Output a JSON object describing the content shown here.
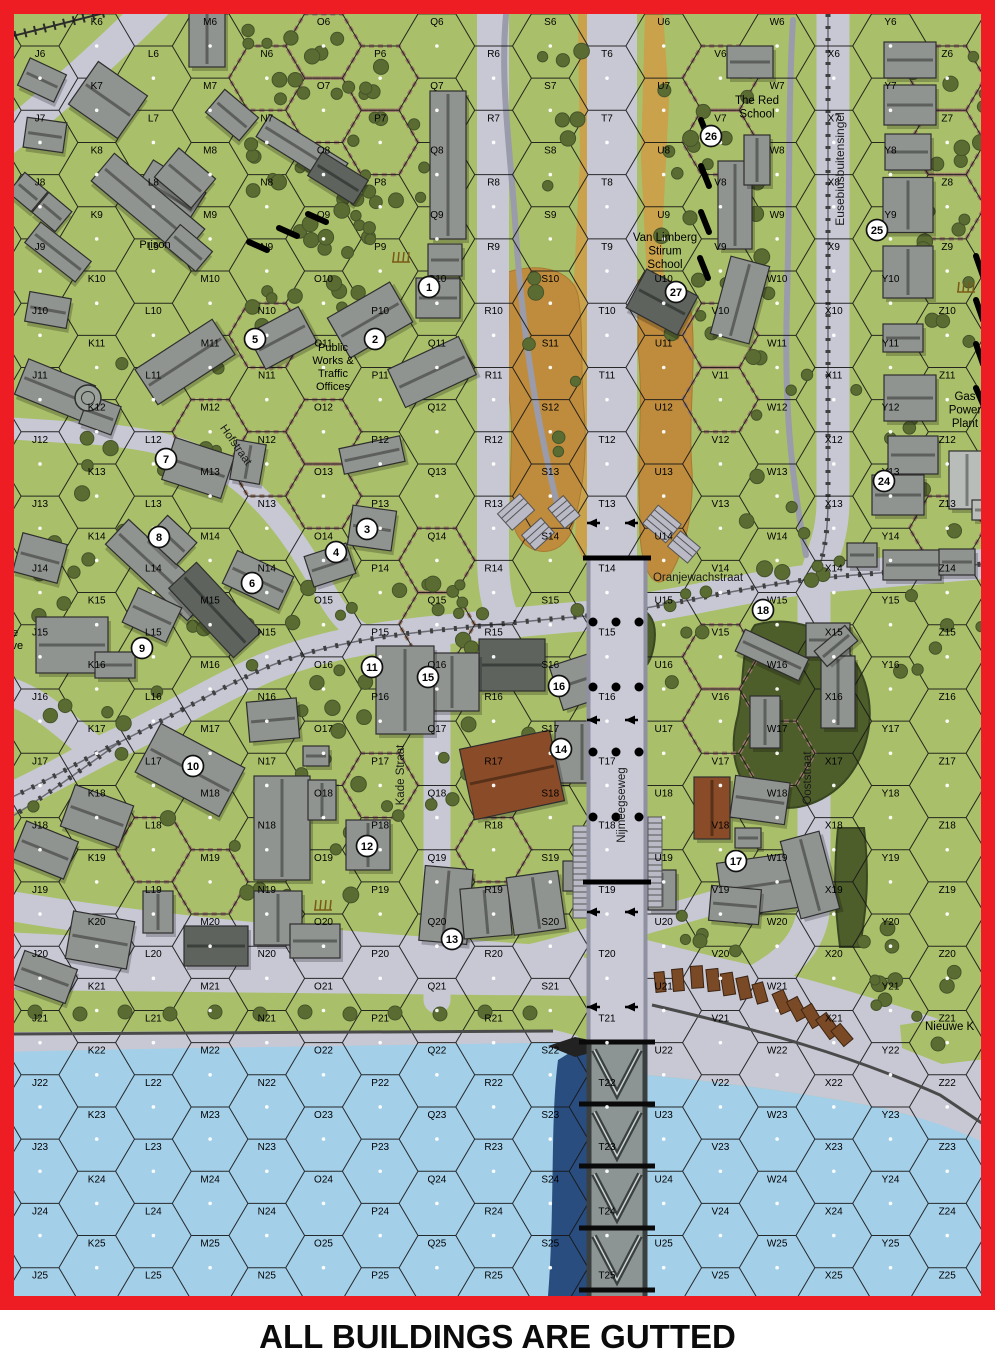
{
  "caption": {
    "text": "ALL BUILDINGS ARE GUTTED"
  },
  "colors": {
    "border": "#ee1c23",
    "green": "#a9bf69",
    "road": "#c7c8d4",
    "road_edge": "#9a9bab",
    "water": "#a4cfe9",
    "bridge_shadow": "#2a4d80",
    "dike_tan": "#c9a24b",
    "marsh": "#bf8c3e",
    "tree": "#5b6c33",
    "tree_edge": "#46542a",
    "woods": "#4e5e2b",
    "woods_edge": "#3a4722",
    "hedge": "#9b7a69",
    "grid": "#161616",
    "label": "#000000",
    "tram": "#3f3f3f",
    "quay_line": "#4a4a4a",
    "truss_deck": "#8d9494",
    "truss_dark": "#39403f",
    "truss_light": "#ccd3d2",
    "bldg_g": "#909490",
    "bldg_d": "#5e635e",
    "bldg_l": "#b9bdb9",
    "bldg_b": "#8a4c28",
    "bldg_stroke": "#2e2e2e",
    "marker_fill": "#ffffff",
    "marker_stroke": "#111111"
  },
  "grid": {
    "cols": "JKLMNOPQRSTUVWXYZ",
    "row_start": 6,
    "row_end": 25,
    "origin_x": 40,
    "col_pitch": 56.7,
    "row_pitch": 64.3,
    "hex_side": 37.8,
    "high_y": 46,
    "low_y": 78.15,
    "clip": [
      14,
      14,
      967,
      1282
    ]
  },
  "streets": [
    {
      "text": "Hofstraat",
      "x": 233,
      "y": 447,
      "rot": 55,
      "size": 11.5
    },
    {
      "text": "Kade Straat",
      "x": 404,
      "y": 775,
      "rot": -90,
      "size": 11.5
    },
    {
      "text": "Nijmeegseweg",
      "x": 625,
      "y": 805,
      "rot": -90,
      "size": 11.5
    },
    {
      "text": "Ooststraat",
      "x": 811,
      "y": 778,
      "rot": -90,
      "size": 11.5
    },
    {
      "text": "Eusebiusbuitensingel",
      "x": 844,
      "y": 169,
      "rot": -90,
      "size": 12
    },
    {
      "text": "Oranjewachstraat",
      "x": 698,
      "y": 581,
      "rot": 0,
      "size": 11.5
    }
  ],
  "landmarks": [
    {
      "lines": [
        "Prison"
      ],
      "x": 155,
      "y": 248,
      "size": 11,
      "anchor": "middle"
    },
    {
      "lines": [
        "The Red",
        "School"
      ],
      "x": 757,
      "y": 104,
      "size": 11.5,
      "anchor": "middle"
    },
    {
      "lines": [
        "Van Limberg",
        "Stirum",
        "School"
      ],
      "x": 665,
      "y": 241,
      "size": 11.5,
      "anchor": "middle"
    },
    {
      "lines": [
        "Public",
        "Works &",
        "Traffic",
        "Offices"
      ],
      "x": 333,
      "y": 351,
      "size": 11,
      "anchor": "middle"
    },
    {
      "lines": [
        "Gas",
        "Power",
        "Plant"
      ],
      "x": 965,
      "y": 400,
      "size": 11.5,
      "anchor": "middle"
    },
    {
      "lines": [
        "Nieuwe K"
      ],
      "x": 925,
      "y": 1030,
      "size": 11.5,
      "anchor": "start"
    },
    {
      "lines": [
        "ate",
        "hive"
      ],
      "x": 3,
      "y": 636,
      "size": 11,
      "anchor": "start"
    }
  ],
  "markers": [
    {
      "n": "1",
      "x": 429,
      "y": 287
    },
    {
      "n": "2",
      "x": 375,
      "y": 339
    },
    {
      "n": "3",
      "x": 367,
      "y": 529
    },
    {
      "n": "4",
      "x": 336,
      "y": 552
    },
    {
      "n": "5",
      "x": 255,
      "y": 339
    },
    {
      "n": "6",
      "x": 252,
      "y": 583
    },
    {
      "n": "7",
      "x": 166,
      "y": 459
    },
    {
      "n": "8",
      "x": 159,
      "y": 537
    },
    {
      "n": "9",
      "x": 142,
      "y": 648
    },
    {
      "n": "10",
      "x": 193,
      "y": 766
    },
    {
      "n": "11",
      "x": 372,
      "y": 667
    },
    {
      "n": "12",
      "x": 367,
      "y": 846
    },
    {
      "n": "13",
      "x": 452,
      "y": 939
    },
    {
      "n": "14",
      "x": 561,
      "y": 749
    },
    {
      "n": "15",
      "x": 428,
      "y": 677
    },
    {
      "n": "16",
      "x": 559,
      "y": 686
    },
    {
      "n": "17",
      "x": 736,
      "y": 861
    },
    {
      "n": "18",
      "x": 763,
      "y": 610
    },
    {
      "n": "24",
      "x": 884,
      "y": 481
    },
    {
      "n": "25",
      "x": 877,
      "y": 230
    },
    {
      "n": "26",
      "x": 711,
      "y": 136
    },
    {
      "n": "27",
      "x": 676,
      "y": 292
    }
  ],
  "roads": [
    {
      "d": "M493,10 L493,555 Q493,605 508,626",
      "w": 32
    },
    {
      "d": "M612,10 L612,565",
      "w": 50
    },
    {
      "d": "M833,10 L833,500 C833,540 820,558 814,585 L814,900 C814,940 790,965 745,987 L660,1008",
      "w": 33
    },
    {
      "d": "M10,798 C60,775 90,755 120,742 C180,712 220,688 265,668 C320,645 380,636 440,630 L520,622 C560,618 585,616 612,614 L690,600 C740,590 780,582 832,577 L995,563",
      "w": 30
    },
    {
      "d": "M75,432 C130,436 180,442 225,470 C270,500 300,545 330,600 C345,625 362,638 385,643",
      "w": 22
    },
    {
      "d": "M155,5 C110,50 60,95 5,140",
      "w": 32
    },
    {
      "d": "M5,428 L80,433",
      "w": 22
    },
    {
      "d": "M5,690 C40,700 70,730 98,753",
      "w": 28
    },
    {
      "d": "M437,636 L437,1000",
      "w": 27
    },
    {
      "d": "M5,905 C120,925 250,938 400,950 L570,962",
      "w": 30
    },
    {
      "d": "M510,960 C560,952 615,930 660,918 C700,907 722,900 742,895",
      "w": 24
    },
    {
      "d": "M506,15 C500,80 510,150 515,220 C520,300 530,380 545,450 C551,480 556,500 560,515",
      "w": 6,
      "c": "road_edge"
    },
    {
      "d": "M793,20 C788,100 790,200 787,300 C784,400 790,470 806,555",
      "w": 6,
      "c": "road_edge"
    }
  ],
  "tram_lines": [
    "M10,798 C60,775 90,755 120,742 C180,712 220,688 265,668 C320,645 380,636 440,630 L520,622 C560,618 585,616 612,614 L690,600 C740,590 780,582 832,577 L995,563",
    "M120,742 C95,760 70,778 45,795 C30,805 20,812 6,820",
    "M828,14 L828,500 C828,540 822,558 817,577"
  ],
  "rail": {
    "d": "M5,38 L108,12"
  },
  "dikes": [
    {
      "d": "M578,14 L592,14 L589,120 L594,260 L589,400 L592,520 L584,562 L575,540 L580,420 L573,300 L580,160 Z"
    },
    {
      "d": "M645,14 L663,14 L669,100 L662,240 L669,380 L660,520 L650,566 L642,440 L648,300 L641,160 Z"
    }
  ],
  "marshes": [
    {
      "d": "M508,272 C540,262 572,270 578,295 C584,330 580,370 584,410 C588,455 582,500 570,535 C555,560 525,555 515,530 C505,490 515,450 510,405 C505,360 512,315 508,272 Z"
    },
    {
      "d": "M638,280 C668,272 690,285 692,320 C696,370 688,420 692,470 C694,510 686,548 670,575 C652,598 638,560 640,520 C636,460 644,400 638,350 Z"
    }
  ],
  "shore": {
    "west_street_band": "M5,932 L200,942 L420,952 L587,958 L587,996 L5,990 Z",
    "west_green_strip": "M5,998 L550,996 L557,1030 L5,1032 Z",
    "west_quay_band": "M5,1032 L555,1030 L578,1036 L578,1054 L5,1054 Z",
    "west_water": "M5,1052 C150,1048 350,1046 587,1042 L587,1296 L5,1296 Z",
    "east_quay": "M647,940 L720,958 C800,975 900,1005 995,1038 L995,1150 C960,1130 910,1112 850,1102 C780,1090 720,1082 647,1075 Z",
    "east_water": "M647,1075 C720,1082 780,1090 850,1102 C910,1112 960,1130 995,1148 L995,1296 L647,1296 Z",
    "east_green_wedge": "M900,1025 L983,1013 L995,1058 L942,1064 L902,1048 Z",
    "shadow": "M587,1042 L587,1296 L548,1296 C555,1210 550,1120 558,1060 Z",
    "west_shore_line": "M5,1034 L553,1031",
    "east_quay_line": "M652,1005 C760,1030 850,1055 940,1095 L995,1132"
  },
  "woods": [
    "M755,625 C800,612 842,638 857,665 C877,700 872,742 852,772 C832,802 790,817 765,802 C735,787 728,750 738,715 C745,680 740,645 755,625 Z",
    "M838,828 L864,828 C870,880 866,910 860,947 L840,947 C834,900 834,868 838,828 Z",
    "M628,610 C648,605 658,620 654,645 C650,668 640,675 630,668 C620,660 618,620 628,610 Z"
  ],
  "hedge_hexes": [
    "N6",
    "O6",
    "O7",
    "P6",
    "P7",
    "N10",
    "M12",
    "N12",
    "O12",
    "O13",
    "Q14",
    "Q15",
    "P17",
    "R18",
    "L18",
    "M19",
    "V6",
    "V7",
    "V10",
    "V11",
    "V15",
    "V16",
    "W17",
    "Z6",
    "Z7",
    "Z8",
    "Z13"
  ],
  "walls": [
    [
      701,
      120,
      709,
      140
    ],
    [
      701,
      166,
      709,
      186
    ],
    [
      701,
      212,
      709,
      232
    ],
    [
      700,
      258,
      708,
      278
    ],
    [
      249,
      242,
      267,
      250
    ],
    [
      279,
      228,
      297,
      236
    ],
    [
      308,
      214,
      326,
      222
    ],
    [
      976,
      256,
      983,
      276
    ],
    [
      976,
      300,
      983,
      320
    ],
    [
      976,
      344,
      983,
      364
    ],
    [
      976,
      388,
      983,
      404
    ]
  ],
  "buildings": [
    [
      42,
      80,
      40,
      30,
      25,
      "g"
    ],
    [
      108,
      100,
      60,
      52,
      35,
      "g"
    ],
    [
      168,
      195,
      62,
      44,
      32,
      "g"
    ],
    [
      207,
      38,
      36,
      58,
      0,
      "g"
    ],
    [
      232,
      115,
      44,
      30,
      40,
      "g"
    ],
    [
      302,
      150,
      92,
      26,
      32,
      "g"
    ],
    [
      338,
      178,
      54,
      28,
      32,
      "d"
    ],
    [
      45,
      135,
      40,
      30,
      8,
      "g"
    ],
    [
      28,
      192,
      30,
      26,
      40,
      "g"
    ],
    [
      52,
      212,
      30,
      26,
      40,
      "g"
    ],
    [
      58,
      252,
      64,
      26,
      38,
      "g"
    ],
    [
      148,
      205,
      118,
      36,
      40,
      "g"
    ],
    [
      185,
      178,
      48,
      38,
      40,
      "g"
    ],
    [
      188,
      248,
      42,
      26,
      40,
      "g"
    ],
    [
      48,
      310,
      42,
      30,
      10,
      "g"
    ],
    [
      55,
      390,
      72,
      38,
      22,
      "g"
    ],
    [
      100,
      415,
      34,
      30,
      20,
      "g"
    ],
    [
      185,
      362,
      92,
      42,
      -33,
      "g"
    ],
    [
      198,
      468,
      62,
      44,
      18,
      "g"
    ],
    [
      248,
      462,
      30,
      40,
      10,
      "g"
    ],
    [
      158,
      570,
      112,
      34,
      43,
      "g"
    ],
    [
      172,
      540,
      40,
      30,
      43,
      "g"
    ],
    [
      40,
      558,
      46,
      40,
      15,
      "g"
    ],
    [
      72,
      645,
      72,
      56,
      0,
      "g"
    ],
    [
      115,
      665,
      40,
      26,
      0,
      "g"
    ],
    [
      152,
      615,
      48,
      38,
      25,
      "g"
    ],
    [
      215,
      610,
      95,
      38,
      47,
      "d"
    ],
    [
      258,
      580,
      62,
      36,
      25,
      "g"
    ],
    [
      282,
      338,
      58,
      40,
      -28,
      "g"
    ],
    [
      370,
      320,
      72,
      46,
      -30,
      "g"
    ],
    [
      438,
      298,
      44,
      40,
      0,
      "g"
    ],
    [
      432,
      372,
      78,
      42,
      -25,
      "g"
    ],
    [
      372,
      455,
      62,
      26,
      -12,
      "g"
    ],
    [
      372,
      528,
      44,
      40,
      8,
      "g"
    ],
    [
      330,
      565,
      44,
      32,
      -18,
      "g"
    ],
    [
      448,
      165,
      36,
      148,
      0,
      "g"
    ],
    [
      445,
      260,
      34,
      32,
      0,
      "g"
    ],
    [
      750,
      62,
      46,
      32,
      0,
      "g"
    ],
    [
      735,
      205,
      34,
      88,
      0,
      "g"
    ],
    [
      757,
      160,
      26,
      50,
      0,
      "g"
    ],
    [
      740,
      300,
      40,
      80,
      15,
      "g"
    ],
    [
      662,
      302,
      58,
      44,
      28,
      "d"
    ],
    [
      910,
      60,
      52,
      36,
      0,
      "g"
    ],
    [
      910,
      105,
      52,
      40,
      0,
      "g"
    ],
    [
      908,
      152,
      46,
      36,
      0,
      "g"
    ],
    [
      908,
      205,
      50,
      55,
      0,
      "g"
    ],
    [
      908,
      272,
      50,
      52,
      0,
      "g"
    ],
    [
      903,
      338,
      40,
      28,
      0,
      "g"
    ],
    [
      910,
      398,
      52,
      46,
      0,
      "g"
    ],
    [
      913,
      455,
      50,
      38,
      0,
      "g"
    ],
    [
      898,
      495,
      52,
      40,
      0,
      "g"
    ],
    [
      967,
      480,
      36,
      58,
      0,
      "l"
    ],
    [
      990,
      510,
      36,
      20,
      0,
      "l"
    ],
    [
      862,
      555,
      30,
      24,
      0,
      "g"
    ],
    [
      912,
      565,
      58,
      30,
      0,
      "g"
    ],
    [
      957,
      562,
      36,
      26,
      0,
      "g"
    ],
    [
      828,
      640,
      44,
      34,
      0,
      "g"
    ],
    [
      838,
      692,
      34,
      72,
      0,
      "g"
    ],
    [
      836,
      646,
      40,
      20,
      -40,
      "g"
    ],
    [
      772,
      655,
      70,
      24,
      25,
      "g"
    ],
    [
      765,
      722,
      30,
      52,
      0,
      "g"
    ],
    [
      712,
      808,
      36,
      62,
      0,
      "b"
    ],
    [
      760,
      800,
      55,
      42,
      8,
      "g"
    ],
    [
      748,
      838,
      26,
      20,
      0,
      "g"
    ],
    [
      760,
      885,
      80,
      55,
      -8,
      "g"
    ],
    [
      810,
      875,
      40,
      80,
      -15,
      "g"
    ],
    [
      735,
      905,
      50,
      35,
      5,
      "g"
    ],
    [
      662,
      890,
      28,
      40,
      0,
      "g"
    ],
    [
      512,
      665,
      66,
      52,
      0,
      "d"
    ],
    [
      452,
      682,
      54,
      58,
      0,
      "g"
    ],
    [
      405,
      690,
      58,
      88,
      0,
      "g"
    ],
    [
      582,
      680,
      54,
      46,
      -18,
      "g"
    ],
    [
      582,
      752,
      54,
      62,
      0,
      "g"
    ],
    [
      512,
      775,
      92,
      72,
      -12,
      "b"
    ],
    [
      368,
      845,
      44,
      50,
      0,
      "g"
    ],
    [
      282,
      828,
      56,
      104,
      0,
      "g"
    ],
    [
      322,
      800,
      28,
      40,
      0,
      "g"
    ],
    [
      273,
      720,
      50,
      40,
      -5,
      "g"
    ],
    [
      316,
      756,
      26,
      20,
      0,
      "g"
    ],
    [
      190,
      770,
      95,
      55,
      28,
      "g"
    ],
    [
      97,
      816,
      62,
      44,
      20,
      "g"
    ],
    [
      45,
      850,
      56,
      40,
      22,
      "g"
    ],
    [
      45,
      977,
      56,
      36,
      20,
      "g"
    ],
    [
      100,
      940,
      62,
      48,
      10,
      "g"
    ],
    [
      158,
      912,
      30,
      42,
      0,
      "g"
    ],
    [
      216,
      946,
      64,
      40,
      0,
      "d"
    ],
    [
      278,
      918,
      48,
      54,
      0,
      "g"
    ],
    [
      315,
      941,
      50,
      34,
      0,
      "g"
    ],
    [
      446,
      905,
      48,
      75,
      5,
      "g"
    ],
    [
      486,
      912,
      48,
      50,
      -5,
      "g"
    ],
    [
      536,
      903,
      52,
      58,
      -8,
      "g"
    ],
    [
      575,
      876,
      24,
      30,
      0,
      "g"
    ]
  ],
  "round_feature": {
    "x": 88,
    "y": 398,
    "r": 13
  },
  "barges": [
    [
      660,
      982,
      10,
      20,
      -6
    ],
    [
      678,
      980,
      11,
      22,
      -5
    ],
    [
      697,
      977,
      12,
      22,
      -4
    ],
    [
      713,
      980,
      12,
      22,
      -6
    ],
    [
      728,
      984,
      12,
      22,
      -9
    ],
    [
      744,
      988,
      12,
      22,
      -12
    ],
    [
      760,
      993,
      11,
      20,
      -16
    ],
    [
      782,
      1002,
      12,
      22,
      -24
    ],
    [
      797,
      1009,
      12,
      22,
      -28
    ],
    [
      812,
      1016,
      12,
      22,
      -31
    ],
    [
      828,
      1026,
      13,
      24,
      -36
    ],
    [
      842,
      1035,
      12,
      20,
      -40
    ]
  ],
  "stairs": [
    [
      516,
      512,
      30,
      22,
      -42
    ],
    [
      538,
      534,
      26,
      20,
      -42
    ],
    [
      564,
      512,
      20,
      26,
      -40
    ],
    [
      662,
      524,
      30,
      24,
      40
    ],
    [
      684,
      547,
      26,
      20,
      40
    ],
    [
      580,
      872,
      14,
      92,
      0
    ],
    [
      655,
      862,
      14,
      90,
      0
    ]
  ],
  "bridge": {
    "deck_x": 587,
    "deck_w": 60,
    "elev_top": 558,
    "truss_top": 1042,
    "bottom": 1296,
    "panel": 62,
    "thick_lines": [
      558,
      882
    ],
    "dot_rows": [
      622,
      687,
      752,
      817
    ],
    "dot_xs": [
      593,
      616,
      639
    ],
    "arrow_rows": [
      523,
      720,
      912,
      1007
    ],
    "pier": "M548,1046 L575,1037 L594,1041 L594,1052 L575,1057 Z"
  },
  "tree_clusters": [
    [
      235,
      25,
      150,
      310,
      46
    ],
    [
      345,
      55,
      90,
      220,
      18
    ],
    [
      525,
      30,
      60,
      480,
      13
    ],
    [
      660,
      40,
      45,
      470,
      11
    ],
    [
      700,
      55,
      75,
      300,
      15
    ],
    [
      900,
      45,
      85,
      280,
      20
    ],
    [
      855,
      330,
      130,
      255,
      13
    ],
    [
      60,
      300,
      180,
      330,
      13
    ],
    [
      25,
      470,
      90,
      160,
      8
    ],
    [
      415,
      565,
      70,
      90,
      10
    ],
    [
      235,
      585,
      170,
      110,
      12
    ],
    [
      300,
      700,
      120,
      120,
      9
    ],
    [
      420,
      690,
      110,
      120,
      9
    ],
    [
      30,
      690,
      170,
      130,
      9
    ],
    [
      230,
      770,
      140,
      130,
      11
    ],
    [
      680,
      900,
      90,
      80,
      6
    ],
    [
      855,
      920,
      130,
      100,
      11
    ],
    [
      740,
      340,
      70,
      200,
      8
    ],
    [
      555,
      560,
      60,
      60,
      5
    ],
    [
      655,
      585,
      60,
      100,
      6
    ],
    [
      745,
      505,
      100,
      100,
      7
    ],
    [
      900,
      580,
      90,
      100,
      6
    ]
  ],
  "shore_trees": [
    [
      35,
      1012
    ],
    [
      80,
      1014
    ],
    [
      125,
      1012
    ],
    [
      170,
      1014
    ],
    [
      215,
      1012
    ],
    [
      260,
      1014
    ],
    [
      305,
      1012
    ],
    [
      350,
      1014
    ],
    [
      395,
      1013
    ],
    [
      440,
      1014
    ],
    [
      485,
      1012
    ],
    [
      530,
      1013
    ],
    [
      700,
      941
    ],
    [
      938,
      1044
    ]
  ],
  "field_icons": [
    [
      400,
      252
    ],
    [
      965,
      282
    ],
    [
      322,
      900
    ]
  ]
}
